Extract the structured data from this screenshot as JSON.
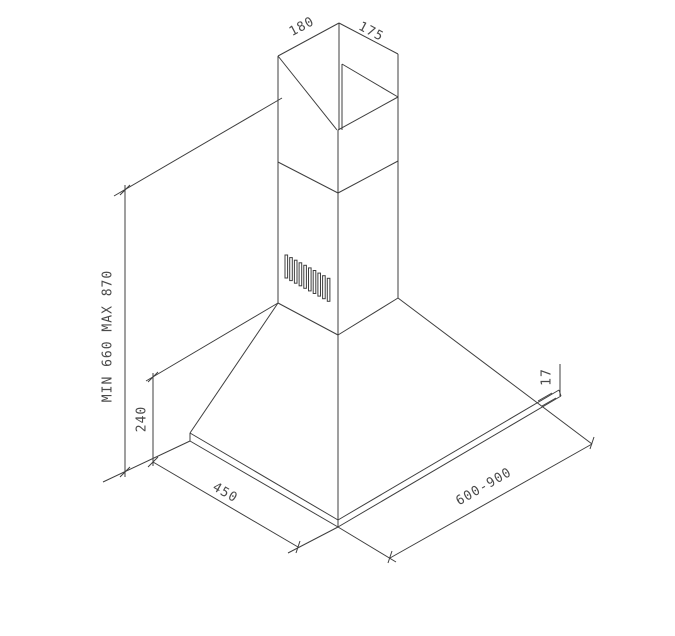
{
  "drawing": {
    "title": "range-hood-dimension-drawing",
    "background_color": "#ffffff",
    "line_color": "#3f3f3f",
    "text_color": "#4a4a4a",
    "labels": {
      "duct_depth": "180",
      "duct_width": "175",
      "height_range": "MIN 660 MAX 870",
      "canopy_height": "240",
      "canopy_depth": "450",
      "canopy_width": "600-900",
      "rim_thickness": "17"
    },
    "grille": {
      "slat_count": 10
    }
  }
}
